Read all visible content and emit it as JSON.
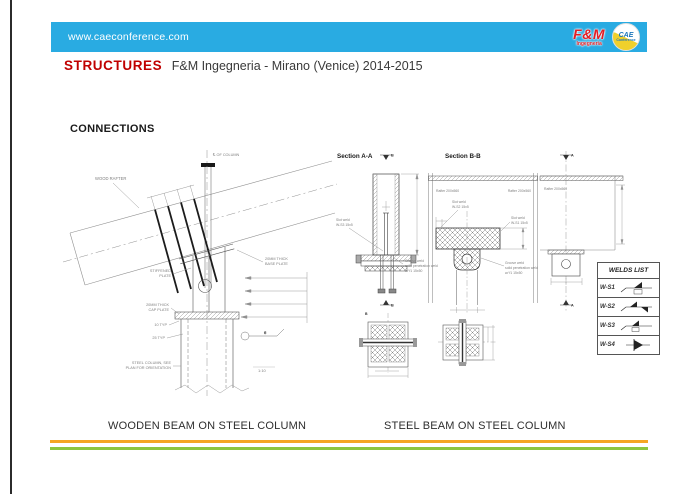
{
  "header": {
    "bar_color": "#29abe2",
    "url": "www.caeconference.com",
    "fm_logo": {
      "line1": "F&M",
      "line2": "Ingegneria",
      "color": "#e31e24"
    },
    "cae_logo": {
      "line1": "CAE",
      "line2": "Conference"
    }
  },
  "title": {
    "highlight": "STRUCTURES",
    "highlight_color": "#c00000",
    "rest": "F&M Ingegneria - Mirano (Venice) 2014-2015"
  },
  "heading": "CONNECTIONS",
  "left_drawing": {
    "labels": {
      "wood_rafter": "WOOD RAFTER",
      "column_centerline": "℄ OF COLUMN",
      "base_plate_l1": "20MM THICK",
      "base_plate_l2": "BASE PLATE",
      "stiffened_l1": "STIFFENED",
      "stiffened_l2": "PLATE",
      "cap_plate_l1": "20MM THICK",
      "cap_plate_l2": "CAP PLATE",
      "typ_10": "10 TYP",
      "typ_25": "25 TYP",
      "steel_column_l1": "STEEL COLUMN, SEE",
      "steel_column_l2": "PLAN FOR ORIENTATION",
      "weld_size": "6",
      "scale_ref": "1:10"
    }
  },
  "sections": {
    "a": {
      "title": "Section A-A",
      "marker": "B",
      "slot_weld_l1": "Slot weld",
      "slot_weld_l2": "W-S3 15x5",
      "groove_weld_l1": "Groove weld",
      "groove_weld_l2": "solid penetration weld",
      "groove_weld_l3": "w/ f1 15x50"
    },
    "b": {
      "title": "Section B-B",
      "rafter_left": "Rafter 200x560",
      "rafter_right": "Rafter 200x560",
      "slot_weld_top_l1": "Slot weld",
      "slot_weld_top_l2": "W-S2 15x5",
      "slot_weld_right_l1": "Slot weld",
      "slot_weld_right_l2": "W-S1 15x5",
      "groove_weld_l1": "Groove weld",
      "groove_weld_l2": "solid penetration weld",
      "groove_weld_l3": "w/ f1 15x50"
    },
    "elevation": {
      "marker_top": "A",
      "marker_bottom": "A",
      "rafter": "Rafter 200x560"
    }
  },
  "welds_list": {
    "title": "WELDS LIST",
    "rows": [
      {
        "id": "W-S1"
      },
      {
        "id": "W-S2"
      },
      {
        "id": "W-S3"
      },
      {
        "id": "W-S4"
      }
    ]
  },
  "captions": {
    "left": "WOODEN BEAM ON STEEL COLUMN",
    "right": "STEEL BEAM ON STEEL COLUMN"
  },
  "footer": {
    "orange": "#f5a623",
    "green": "#8dc63f"
  }
}
